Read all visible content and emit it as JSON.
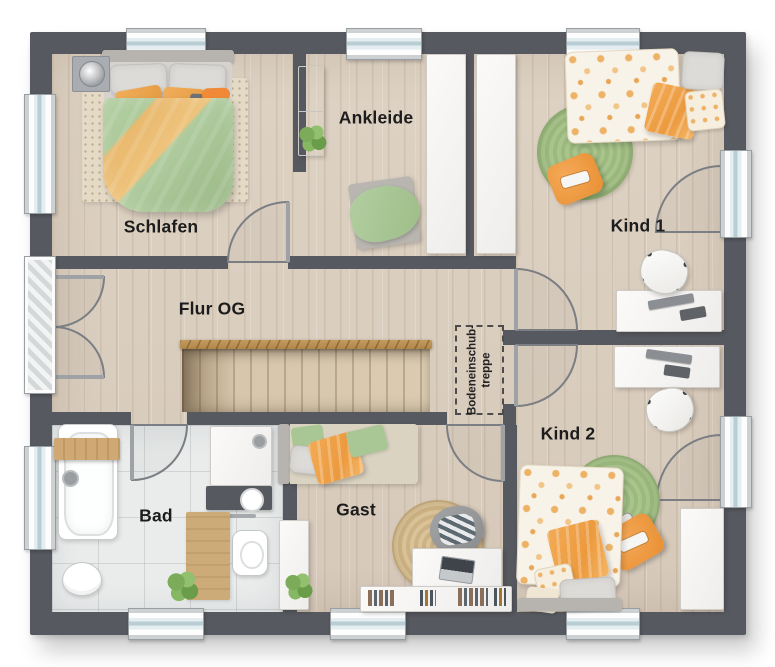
{
  "plan": {
    "labels": {
      "schlafen": "Schlafen",
      "ankleide": "Ankleide",
      "kind1": "Kind 1",
      "kind2": "Kind 2",
      "flur": "Flur OG",
      "bad": "Bad",
      "gast": "Gast"
    },
    "attic_hatch": {
      "line1": "Bodeneinschub-",
      "line2": "treppe"
    },
    "colors": {
      "wall": "#56595f",
      "floor": "#dccfc0",
      "tile": "#eaecec",
      "orange": "#e9a65a",
      "green": "#a7c493",
      "rail": "#c49a5f",
      "label": "#1c1c1c"
    }
  }
}
